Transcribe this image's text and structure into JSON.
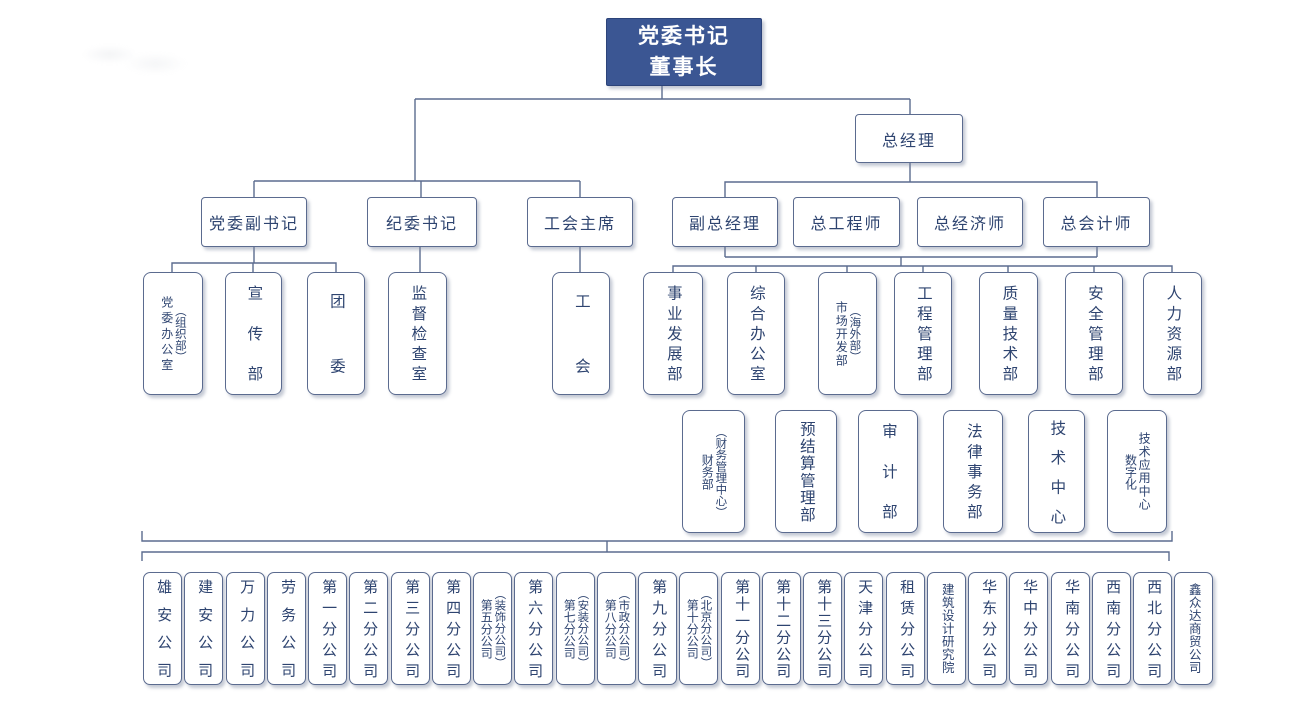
{
  "colors": {
    "primary_fill": "#3b5693",
    "box_border": "#5b6b8f",
    "connector_line": "#5b6b8f",
    "text": "#2e4470",
    "root_text": "#ffffff"
  },
  "root": {
    "line1": "党委书记",
    "line2": "董事长"
  },
  "executives": {
    "general_manager": "总经理",
    "party_deputy_secretary": "党委副书记",
    "discipline_secretary": "纪委书记",
    "union_chairman": "工会主席",
    "deputy_general_manager": "副总经理",
    "chief_engineer": "总工程师",
    "chief_economist": "总经济师",
    "chief_accountant": "总会计师"
  },
  "party_union_departments": [
    {
      "label": "党委办公室",
      "sublabel": "（组织部）"
    },
    {
      "label": "宣传部"
    },
    {
      "label": "团委"
    },
    {
      "label": "监督检查室"
    },
    {
      "label": "工会"
    }
  ],
  "management_departments": [
    {
      "label": "事业发展部"
    },
    {
      "label": "综合办公室"
    },
    {
      "label": "市场开发部",
      "sublabel": "（海外部）"
    },
    {
      "label": "工程管理部"
    },
    {
      "label": "质量技术部"
    },
    {
      "label": "安全管理部"
    },
    {
      "label": "人力资源部"
    }
  ],
  "support_departments": [
    {
      "label": "财务部",
      "sublabel": "（财务管理中心）"
    },
    {
      "label": "预结算管理部"
    },
    {
      "label": "审计部"
    },
    {
      "label": "法律事务部"
    },
    {
      "label": "技术中心"
    },
    {
      "label": "技术应用中心",
      "sublabel": "数字化"
    }
  ],
  "subsidiaries": [
    {
      "label": "雄安公司"
    },
    {
      "label": "建安公司"
    },
    {
      "label": "万力公司"
    },
    {
      "label": "劳务公司"
    },
    {
      "label": "第一分公司"
    },
    {
      "label": "第二分公司"
    },
    {
      "label": "第三分公司"
    },
    {
      "label": "第四分公司"
    },
    {
      "label": "第五分公司",
      "sublabel": "（装饰分公司）"
    },
    {
      "label": "第六分公司"
    },
    {
      "label": "第七分公司",
      "sublabel": "（安装分公司）"
    },
    {
      "label": "第八分公司",
      "sublabel": "（市政分公司）"
    },
    {
      "label": "第九分公司"
    },
    {
      "label": "第十分公司",
      "sublabel": "（北京分公司）"
    },
    {
      "label": "第十一分公司"
    },
    {
      "label": "第十二分公司"
    },
    {
      "label": "第十三分公司"
    },
    {
      "label": "天津分公司"
    },
    {
      "label": "租赁分公司"
    },
    {
      "label": "建筑设计研究院"
    },
    {
      "label": "华东分公司"
    },
    {
      "label": "华中分公司"
    },
    {
      "label": "华南分公司"
    },
    {
      "label": "西南分公司"
    },
    {
      "label": "西北分公司"
    },
    {
      "label": "鑫众达商贸公司"
    }
  ]
}
